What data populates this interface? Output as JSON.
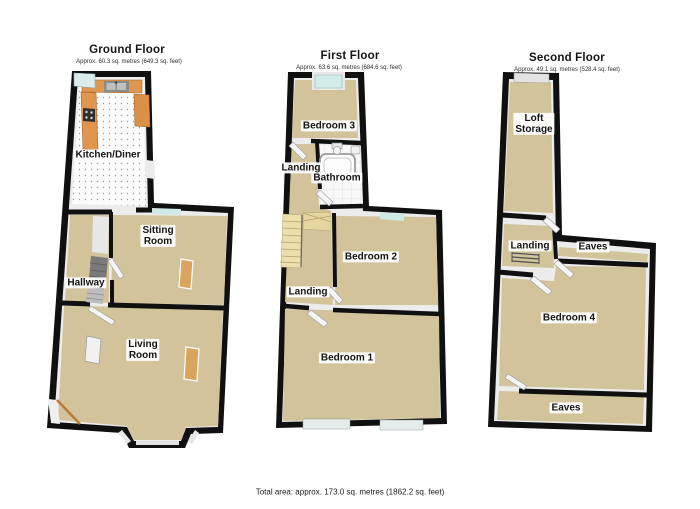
{
  "page": {
    "background": "#ffffff",
    "total_area_label": "Total area: approx. 173.0 sq. metres (1862.2 sq. feet)"
  },
  "palette": {
    "wall": "#101010",
    "wall_inner_face": "#ececec",
    "carpet": "#d2c39b",
    "kitchen_floor": "#fbfbfb",
    "window_glass": "#cfe9e7",
    "kitchen_units": "#e0964f",
    "stairs": "#ecdfae",
    "radiator": "#d9a55e",
    "label_text": "#141414",
    "label_background": "#ffffff"
  },
  "floors": [
    {
      "id": "ground-floor",
      "title": "Ground Floor",
      "subtitle": "Approx. 60.3 sq. metres (649.3 sq. feet)",
      "rooms": [
        {
          "name": "Kitchen/Diner"
        },
        {
          "name": "Sitting\nRoom"
        },
        {
          "name": "Hallway"
        },
        {
          "name": "Living\nRoom"
        }
      ]
    },
    {
      "id": "first-floor",
      "title": "First Floor",
      "subtitle": "Approx. 63.6 sq. metres (684.6 sq. feet)",
      "rooms": [
        {
          "name": "Bedroom 3"
        },
        {
          "name": "Landing"
        },
        {
          "name": "Bathroom"
        },
        {
          "name": "Bedroom 2"
        },
        {
          "name": "Landing"
        },
        {
          "name": "Bedroom 1"
        }
      ]
    },
    {
      "id": "second-floor",
      "title": "Second Floor",
      "subtitle": "Approx. 49.1 sq. metres (528.4 sq. feet)",
      "rooms": [
        {
          "name": "Loft\nStorage"
        },
        {
          "name": "Landing"
        },
        {
          "name": "Eaves"
        },
        {
          "name": "Bedroom 4"
        },
        {
          "name": "Eaves"
        }
      ]
    }
  ]
}
